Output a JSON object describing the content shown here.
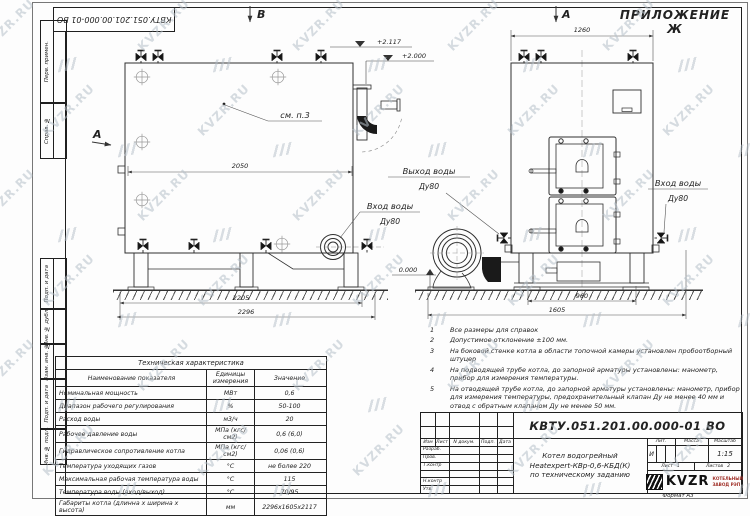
{
  "sheet": {
    "appendix": "ПРИЛОЖЕНИЕ Ж",
    "doc_number": "КВТУ.051.201.00.000-01 ВО",
    "format": "Формат А3",
    "watermark": "KVZR.RU"
  },
  "frame": {
    "left_labels": [
      "Перв. примен.",
      "Справ. №",
      "Подп. и дата",
      "Инв. № дубл.",
      "Взам. инв. №",
      "Подп. и дата",
      "Инв. № подл."
    ]
  },
  "drawing": {
    "section_label": "B",
    "view_label_side": "А",
    "view_label_front": "А",
    "see_note": "см. п.3",
    "dims": {
      "side_width": "2050",
      "side_base": "2205",
      "side_overall": "2296",
      "front_width": "1260",
      "front_base": "960",
      "front_overall": "1605"
    },
    "elevations": {
      "top": "+2.117",
      "outlet": "+2.000",
      "zero": "0.000"
    },
    "ports": {
      "outlet_title": "Выход воды",
      "outlet_dn": "Ду80",
      "inlet_side_title": "Вход воды",
      "inlet_side_dn": "Ду80",
      "inlet_front_title": "Вход воды",
      "inlet_front_dn": "Ду80"
    }
  },
  "notes": {
    "items": [
      {
        "num": "1",
        "text": "Все размеры для справок"
      },
      {
        "num": "2",
        "text": "Допустимое отклонение ±100 мм."
      },
      {
        "num": "3",
        "text": "На боковой стенке котла в области топочной камеры установлен пробоотборный штуцер"
      },
      {
        "num": "4",
        "text": "На подводящей трубе котла, до запорной арматуры установлены: манометр, прибор для измерения температуры."
      },
      {
        "num": "5",
        "text": "На отводящей трубе котла, до запорной арматуры установлены: манометр, прибор для измерения температуры, предохранительный клапан Ду не менее 40 мм и отвод с обратным клапаном Ду не менее 50 мм."
      }
    ]
  },
  "spec_table": {
    "title": "Техническая характеристика",
    "headers": [
      "Наименование показателя",
      "Единицы измерения",
      "Значение"
    ],
    "rows": [
      [
        "Номинальная мощность",
        "МВт",
        "0,6"
      ],
      [
        "Диапазон рабочего регулирования",
        "%",
        "50-100"
      ],
      [
        "Расход воды",
        "м3/ч",
        "20"
      ],
      [
        "Рабочее давление воды",
        "МПа (кгс/см2)",
        "0,6 (6,0)"
      ],
      [
        "Гидравлическое сопротивление котла",
        "МПа (кгс/см2)",
        "0,06 (0,6)"
      ],
      [
        "Температура уходящих газов",
        "°С",
        "не более 220"
      ],
      [
        "Максимальная рабочая температура воды",
        "°С",
        "115"
      ],
      [
        "Температура воды (вход/выход)",
        "°С",
        "70/95"
      ],
      [
        "Габариты котла (длинна х ширина х высота)",
        "мм",
        "2296х1605х2117"
      ]
    ]
  },
  "title_block": {
    "doc_number": "КВТУ.051.201.00.000-01 ВО",
    "product_lines": [
      "Котел водогрейный",
      "Heatexpert-КВр-0,6-КБД(К)",
      "по техническому заданию"
    ],
    "columns": [
      "Изм",
      "Лист",
      "N докум.",
      "Подп.",
      "Дата"
    ],
    "rows": [
      "Разраб.",
      "Пров.",
      "Т.контр",
      "",
      "Н.контр",
      "Утв."
    ],
    "lit_header": "Лит.",
    "mass_header": "Масса",
    "scale_header": "Масштаб",
    "lit_value": "И",
    "scale_value": "1:15",
    "sheet_label": "Лист",
    "sheet_value": "1",
    "sheets_label": "Листов",
    "sheets_value": "2",
    "company": "KVZR",
    "company_sub1": "КОТЕЛЬНЫЙ",
    "company_sub2": "ЗАВОД РЭП"
  }
}
